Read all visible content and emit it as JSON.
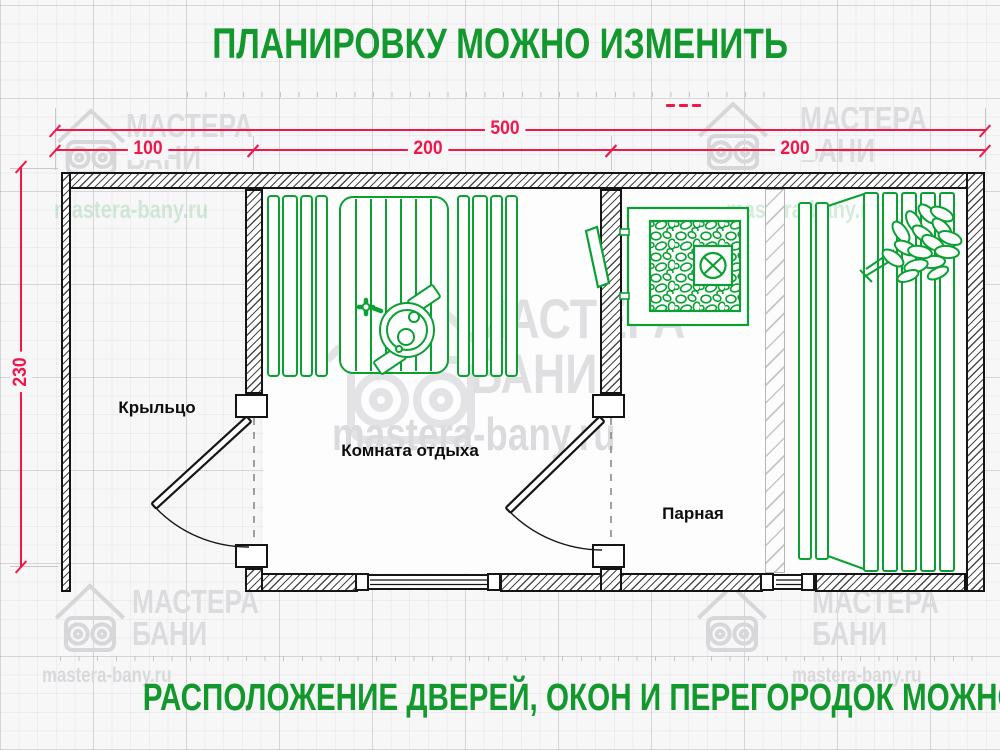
{
  "title_top": "ПЛАНИРОВКУ МОЖНО ИЗМЕНИТЬ",
  "title_bottom": "РАСПОЛОЖЕНИЕ ДВЕРЕЙ, ОКОН И ПЕРЕГОРОДОК МОЖНО МЕНЯТЬ",
  "colors": {
    "title_green": "#12982d",
    "dimension_red": "#f3164b",
    "drawing_green": "#0aa133",
    "wall_ink": "#141414"
  },
  "dimensions": {
    "overall": {
      "value": "500"
    },
    "top_segments": [
      {
        "value": "100"
      },
      {
        "value": "200"
      },
      {
        "value": "200"
      }
    ],
    "side": {
      "value": "230"
    }
  },
  "rooms": [
    {
      "name": "Крыльцо"
    },
    {
      "name": "Комната отдыха"
    },
    {
      "name": "Парная"
    }
  ],
  "watermark": {
    "brand_line1": "МАСТЕРА",
    "brand_line2": "БАНИ",
    "site": "mastera-bany.ru"
  }
}
